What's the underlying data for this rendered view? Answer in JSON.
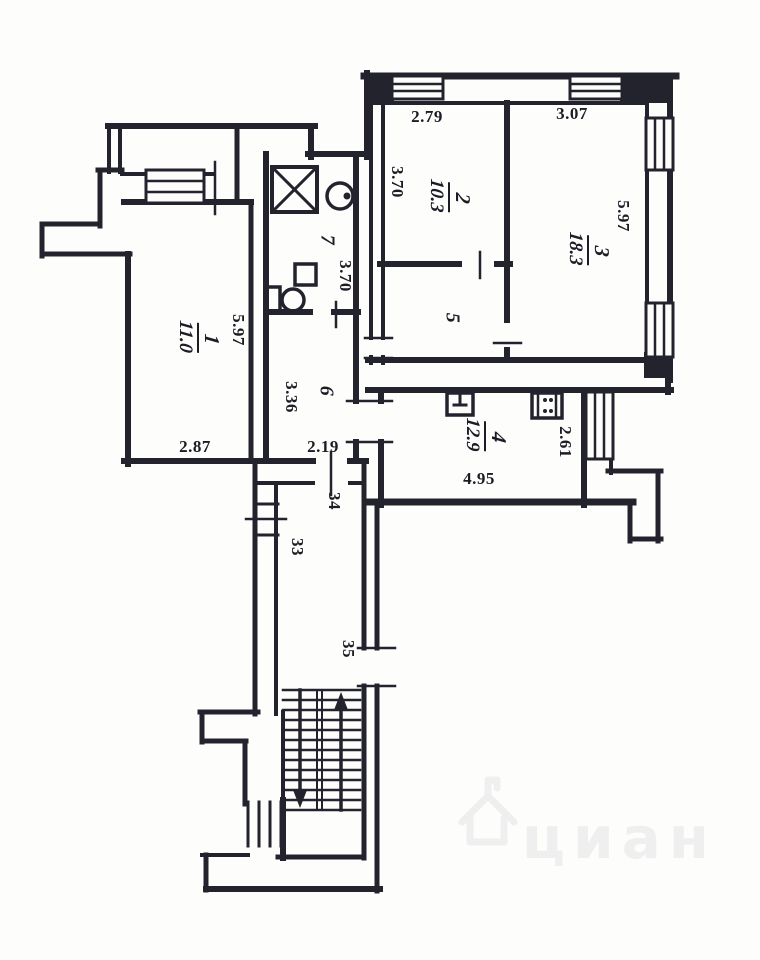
{
  "title": "apartment-floor-plan",
  "rooms": [
    {
      "number": "1",
      "area": "11.0"
    },
    {
      "number": "2",
      "area": "10.3"
    },
    {
      "number": "3",
      "area": "18.3"
    },
    {
      "number": "4",
      "area": "12.9"
    },
    {
      "number": "5"
    },
    {
      "number": "6"
    },
    {
      "number": "7"
    }
  ],
  "dimensions": {
    "d279": "2.79",
    "d307": "3.07",
    "d370_room2": "3.70",
    "d370_bath": "3.70",
    "d597_room3": "5.97",
    "d597_room1": "5.97",
    "d287": "2.87",
    "d219": "2.19",
    "d336": "3.36",
    "d261": "2.61",
    "d495": "4.95"
  },
  "landing_numbers": {
    "n33": "33",
    "n34": "34",
    "n35": "35"
  },
  "watermark": {
    "text": "циан"
  },
  "colors": {
    "wall": "#23232e",
    "background": "#fdfdfc",
    "watermark": "#efefef"
  }
}
